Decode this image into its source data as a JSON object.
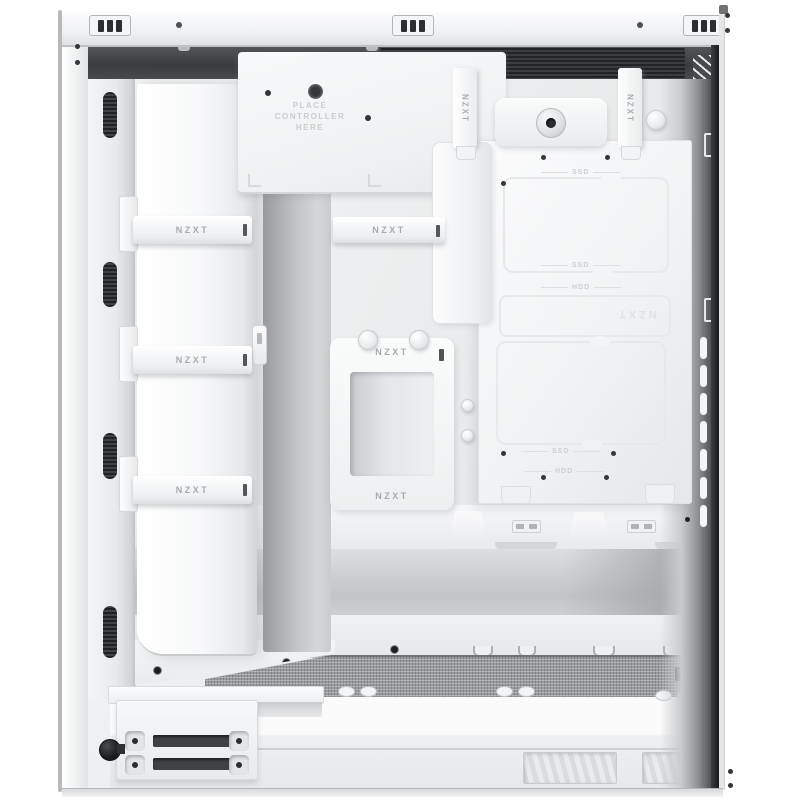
{
  "labels": {
    "strap": "NZXT",
    "ssd": "SSD",
    "hdd": "HDD",
    "etched_brand": "NZXT",
    "controller_hint": {
      "line1": "PLACE",
      "line2": "CONTROLLER",
      "line3": "HERE"
    }
  },
  "colors": {
    "case_white": "#f4f5f6",
    "panel_shade": "#dfe1e3",
    "slot_dark": "#2e3032",
    "top_band_dark": "#3a3c3e",
    "mesh_grey": "#989b9d",
    "strap_text": "#a6abaf",
    "etch_grey": "#ccced0"
  }
}
